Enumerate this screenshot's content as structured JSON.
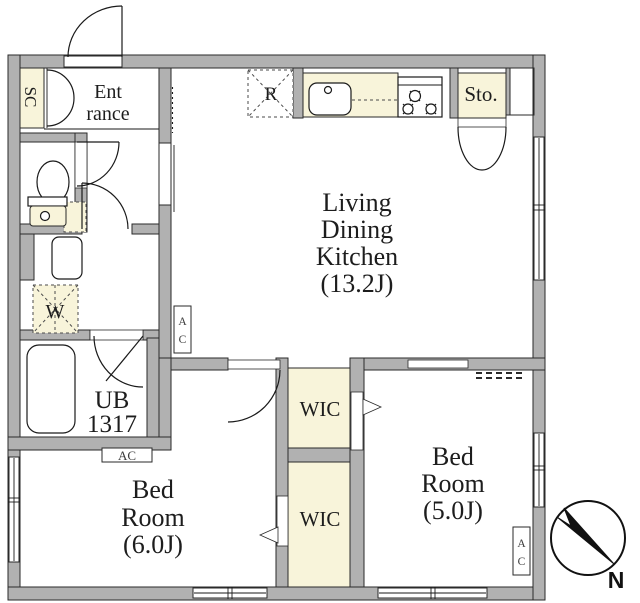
{
  "plan": {
    "labels": {
      "shoe_closet": "SC",
      "entrance_line1": "Ent",
      "entrance_line2": "rance",
      "refrigerator": "R",
      "storage": "Sto.",
      "ldk_line1": "Living",
      "ldk_line2": "Dining",
      "ldk_line3": "Kitchen",
      "ldk_line4": "(13.2J)",
      "wic_upper": "WIC",
      "wic_lower": "WIC",
      "bedroom6_line1": "Bed",
      "bedroom6_line2": "Room",
      "bedroom6_line3": "(6.0J)",
      "bedroom5_line1": "Bed",
      "bedroom5_line2": "Room",
      "bedroom5_line3": "(5.0J)",
      "unit_bath_line1": "UB",
      "unit_bath_line2": "1317",
      "washer": "W",
      "ac_line1": "A",
      "ac_line2": "C",
      "ac": "AC",
      "north": "N"
    },
    "colors": {
      "wall": "#b1b1b1",
      "closet": "#f8f4da",
      "background": "#ffffff"
    }
  }
}
